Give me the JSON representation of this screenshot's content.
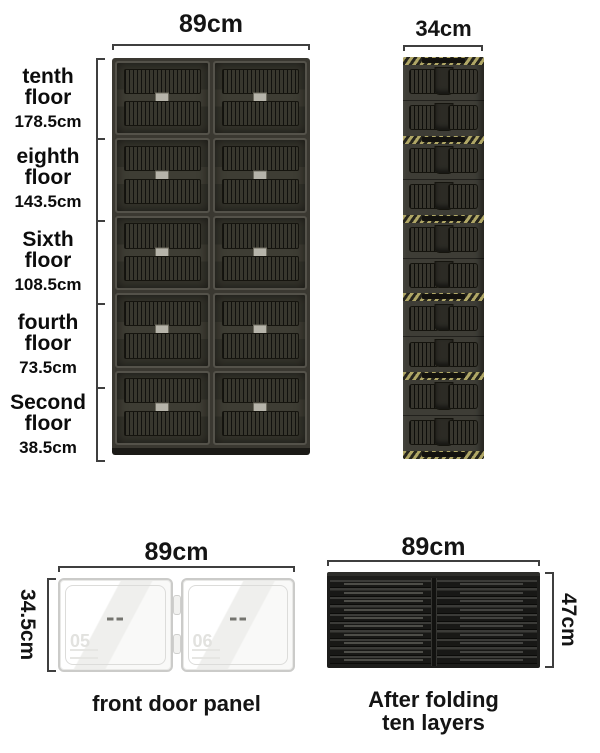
{
  "cabinet": {
    "width_label": "89cm",
    "rows": 5,
    "cols": 2,
    "floors": [
      {
        "line1": "tenth",
        "line2": "floor",
        "height": "178.5cm"
      },
      {
        "line1": "eighth",
        "line2": "floor",
        "height": "143.5cm"
      },
      {
        "line1": "Sixth",
        "line2": "floor",
        "height": "108.5cm"
      },
      {
        "line1": "fourth",
        "line2": "floor",
        "height": "73.5cm"
      },
      {
        "line1": "Second",
        "line2": "floor",
        "height": "38.5cm"
      }
    ]
  },
  "folded_stack": {
    "width_label": "34cm",
    "modules": 5,
    "layers_per_module": 2
  },
  "door_panel": {
    "width_label": "89cm",
    "height_label": "34.5cm",
    "caption": "front door panel",
    "watermark_left": "05",
    "watermark_right": "06"
  },
  "folded_flat": {
    "width_label": "89cm",
    "height_label": "47cm",
    "slats": 10,
    "caption_line1": "After folding",
    "caption_line2": "ten layers"
  },
  "colors": {
    "background": "#ffffff",
    "cabinet_dark": "#34332b",
    "frame_gray": "#54524a",
    "hazard_yellow": "#b0a766",
    "door_white": "#fafaf9",
    "flat_black": "#1d1d1b",
    "text": "#141414"
  }
}
